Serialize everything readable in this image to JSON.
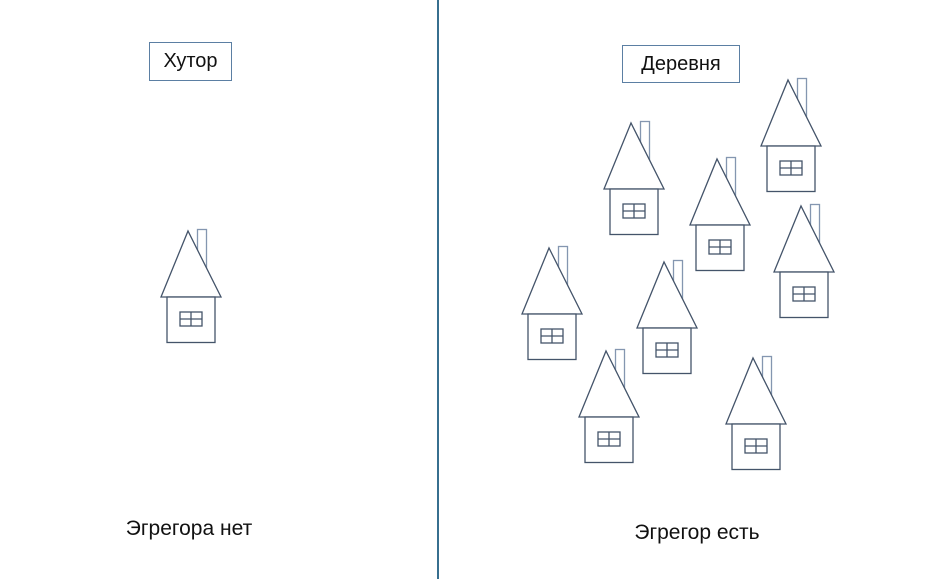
{
  "canvas": {
    "width": 925,
    "height": 579,
    "background": "#ffffff"
  },
  "colors": {
    "house_line": "#44546a",
    "chimney_line": "#8496b0",
    "divider": "#376f8f",
    "box_border": "#5b7fa3",
    "text": "#111111"
  },
  "left_panel": {
    "title": "Хутор",
    "caption": "Эгрегора нет",
    "house_count": 1,
    "houses": [
      {
        "x": 160,
        "y": 229
      }
    ]
  },
  "right_panel": {
    "title": "Деревня",
    "caption": "Эгрегор есть",
    "house_count": 8,
    "houses": [
      {
        "x": 760,
        "y": 78
      },
      {
        "x": 603,
        "y": 121
      },
      {
        "x": 689,
        "y": 157
      },
      {
        "x": 773,
        "y": 204
      },
      {
        "x": 521,
        "y": 246
      },
      {
        "x": 636,
        "y": 260
      },
      {
        "x": 578,
        "y": 349
      },
      {
        "x": 725,
        "y": 356
      }
    ]
  }
}
